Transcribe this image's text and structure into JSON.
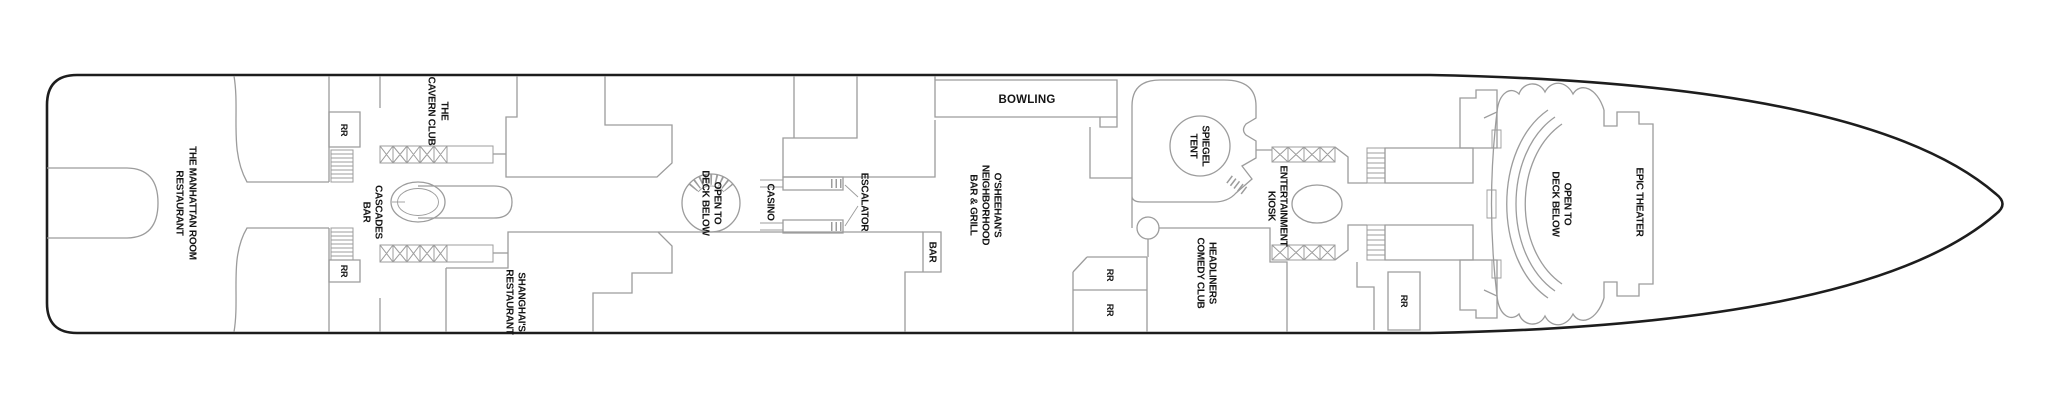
{
  "colors": {
    "background": "#ffffff",
    "hull_outline": "#1d1d1d",
    "interior_walls": "#9c9c9c",
    "label_text": "#141414"
  },
  "labels": {
    "manhattan": {
      "line1": "THE MANHATTAN ROOM",
      "line2": "RESTAURANT"
    },
    "cavern_club": {
      "line1": "THE",
      "line2": "CAVERN CLUB"
    },
    "rr": "RR",
    "cascades_bar": {
      "line1": "CASCADES",
      "line2": "BAR"
    },
    "shanghais": {
      "line1": "SHANGHAI'S",
      "line2": "RESTAURANT"
    },
    "open_to_deck_below": {
      "line1": "OPEN TO",
      "line2": "DECK BELOW"
    },
    "casino": "CASINO",
    "escalator": "ESCALATOR",
    "bar": "BAR",
    "bowling": "BOWLING",
    "osheehans": {
      "line1": "O'SHEEHAN'S",
      "line2": "NEIGHBORHOOD",
      "line3": "BAR & GRILL"
    },
    "spiegel_tent": {
      "line1": "SPIEGEL",
      "line2": "TENT"
    },
    "entertainment_kiosk": {
      "line1": "ENTERTAINMENT",
      "line2": "KIOSK"
    },
    "headliners": {
      "line1": "HEADLINERS",
      "line2": "COMEDY CLUB"
    },
    "epic_theater": "EPIC THEATER"
  }
}
